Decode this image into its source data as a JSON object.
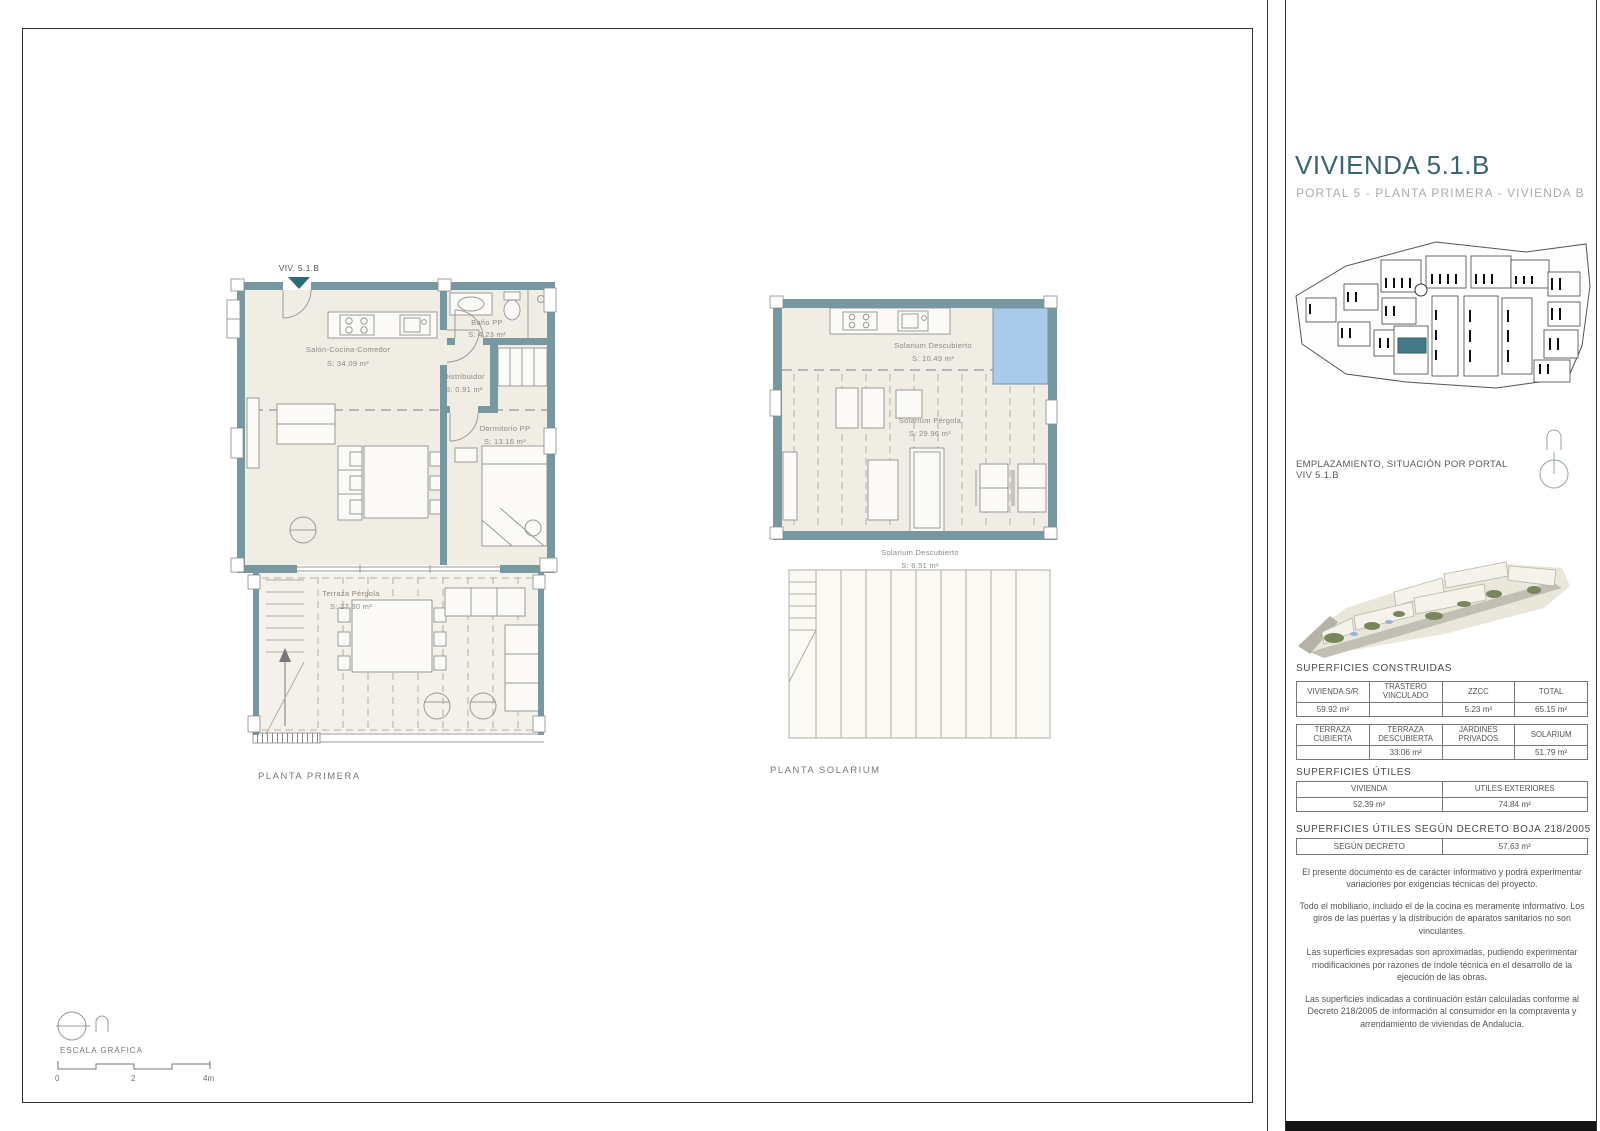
{
  "sheet": {
    "title": "VIVIENDA 5.1.B",
    "subtitle": "PORTAL 5 - PLANTA PRIMERA - VIVIENDA B",
    "emplazamiento": "EMPLAZAMIENTO, SITUACIÓN POR PORTAL VIV 5.1.B"
  },
  "plan_primera": {
    "caption": "PLANTA PRIMERA",
    "unit_marker": "VIV. 5.1.B",
    "rooms": {
      "salon": {
        "name": "Salón-Cocina-Comedor",
        "area": "S: 34.09 m²"
      },
      "bano": {
        "name": "Baño PP",
        "area": "S: 4.23 m²"
      },
      "distribuidor": {
        "name": "Distribuidor",
        "area": "S: 0.91 m²"
      },
      "dormitorio": {
        "name": "Dormitorio PP",
        "area": "S: 13.16 m²"
      },
      "terraza": {
        "name": "Terraza Pérgola",
        "area": "S: 27.80 m²"
      }
    }
  },
  "plan_solarium": {
    "caption": "PLANTA SOLARIUM",
    "rooms": {
      "descubierto_sup": {
        "name": "Solarium Descubierto",
        "area": "S: 10.49 m²"
      },
      "pergola": {
        "name": "Solarium Pérgola",
        "area": "S: 29.96 m²"
      },
      "descubierto_inf": {
        "name": "Solarium Descubierto",
        "area": "S: 6.51 m²"
      }
    }
  },
  "escala": {
    "label": "ESCALA GRÁFICA",
    "ticks": [
      "0",
      "2",
      "4m"
    ]
  },
  "superficies_construidas": {
    "heading": "SUPERFICIES CONSTRUIDAS",
    "tabla1": {
      "headers": [
        "VIVIENDA S/R",
        "TRASTERO VINCULADO",
        "ZZCC",
        "TOTAL"
      ],
      "values": [
        "59.92 m²",
        "",
        "5.23 m²",
        "65.15 m²"
      ]
    },
    "tabla2": {
      "headers": [
        "TERRAZA CUBIERTA",
        "TERRAZA DESCUBIERTA",
        "JARDINES PRIVADOS",
        "SOLARIUM"
      ],
      "values": [
        "",
        "33.06 m²",
        "",
        "51.79 m²"
      ]
    }
  },
  "superficies_utiles": {
    "heading": "SUPERFICIES ÚTILES",
    "headers": [
      "VIVIENDA",
      "UTILES EXTERIORES"
    ],
    "values": [
      "52.39 m²",
      "74.84 m²"
    ]
  },
  "superficies_decreto": {
    "heading": "SUPERFICIES ÚTILES SEGÚN DECRETO BOJA 218/2005",
    "label": "SEGÚN DECRETO",
    "value": "57.63 m²"
  },
  "notas": [
    "El presente documento es de carácter informativo y podrá experimentar variaciones por exigencias técnicas del proyecto.",
    "Todo el mobiliario, incluido el de la cocina es meramente informativo. Los giros de las puertas y la distribución de aparatos sanitarios no son vinculantes.",
    "Las superficies expresadas son aproximadas, pudiendo experimentar modificaciones por razones de índole técnica en el desarrollo de la ejecución de las obras.",
    "Las superficies indicadas a continuación están calculadas conforme al Decreto 218/2005 de información al consumidor en la compraventa y arrendamiento de viviendas de Andalucía."
  ],
  "colors": {
    "accent": "#3a6570",
    "wall": "#7797a1",
    "floor": "#f0ede4",
    "pool": "#a9cbe9",
    "highlight": "#477a88"
  }
}
